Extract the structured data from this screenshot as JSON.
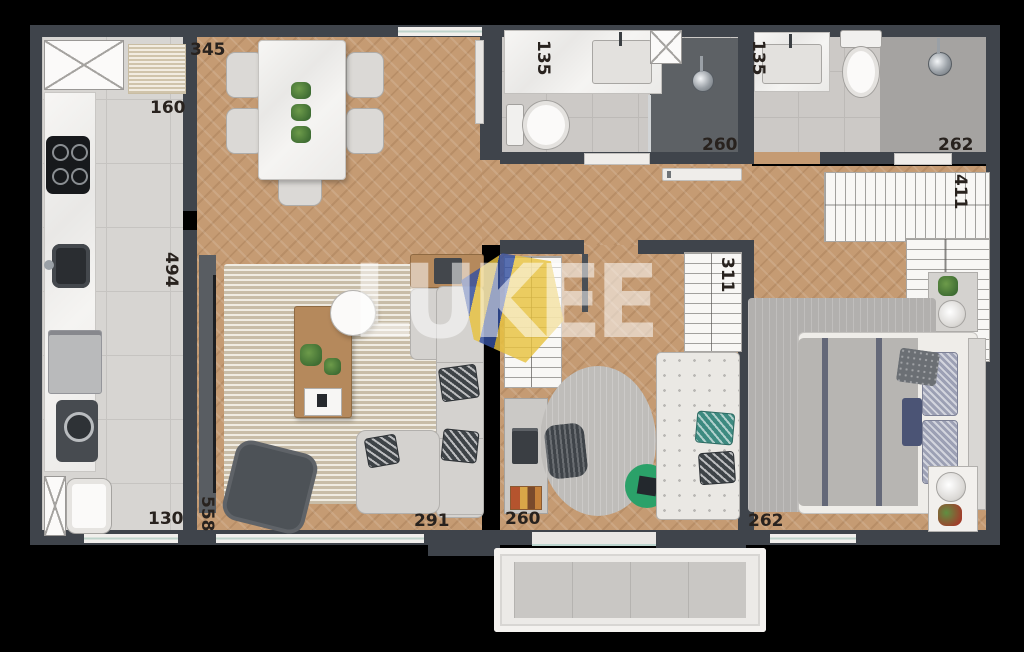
{
  "watermark": {
    "text": "LUKEE"
  },
  "dimensions": {
    "dining_top": "345",
    "kitchen_pass": "160",
    "kitchen_length": "494",
    "service_width": "130",
    "living_length": "558",
    "living_width": "291",
    "bath1_width": "135",
    "bath1_length": "260",
    "bath2_width": "135",
    "bath2_length": "262",
    "closet_length": "411",
    "wardrobe_length": "311",
    "office_width": "260",
    "bedroom_width": "262"
  },
  "colors": {
    "background": "#000000",
    "wall": "#3f444b",
    "wood_floor": "#c59b73",
    "tile_floor": "#d7d5d2",
    "accent_green": "#2ba169",
    "watermark_gold": "#e8c23f",
    "watermark_blue": "#3450a0"
  }
}
